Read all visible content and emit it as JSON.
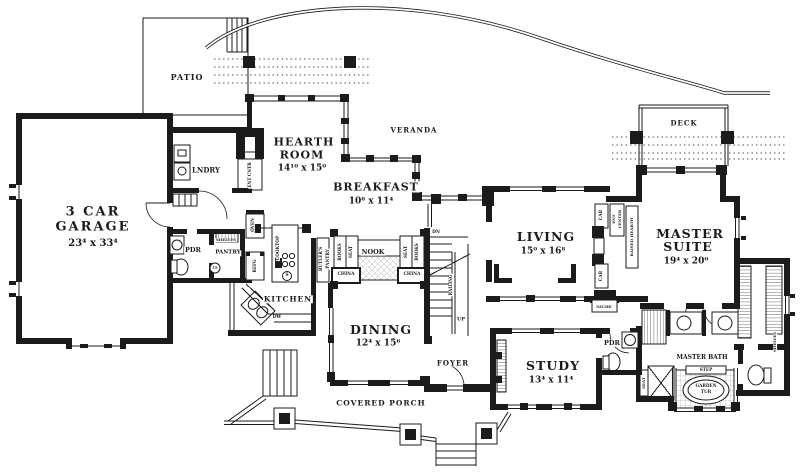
{
  "colors": {
    "ink": "#1b1b1b",
    "paper": "#ffffff",
    "dots": "#555555"
  },
  "plan_type": "single-story house floor plan",
  "rooms": [
    {
      "name": "3 Car Garage",
      "dims": "23⁴ x 33⁴"
    },
    {
      "name": "Hearth Room",
      "dims": "14¹⁰ x 15⁰"
    },
    {
      "name": "Breakfast",
      "dims": "10⁸ x 11⁴"
    },
    {
      "name": "Living",
      "dims": "15⁰ x 16⁸"
    },
    {
      "name": "Master Suite",
      "dims": "19⁴ x 20⁰"
    },
    {
      "name": "Dining",
      "dims": "12⁴ x 15⁶"
    },
    {
      "name": "Study",
      "dims": "13⁴ x 11⁴"
    },
    {
      "name": "Patio"
    },
    {
      "name": "Veranda"
    },
    {
      "name": "Deck"
    },
    {
      "name": "Kitchen"
    },
    {
      "name": "Pantry"
    },
    {
      "name": "Lndry"
    },
    {
      "name": "Foyer"
    },
    {
      "name": "Nook"
    },
    {
      "name": "Covered Porch"
    },
    {
      "name": "Master Bath"
    },
    {
      "name": "Pdr"
    }
  ],
  "labels": [
    {
      "id": "patio",
      "text": "PATIO",
      "x": 187,
      "y": 77,
      "fs": 8,
      "ls": 1
    },
    {
      "id": "garage-line1",
      "text": "3 CAR",
      "x": 93,
      "y": 212,
      "fs": 13,
      "ls": 2
    },
    {
      "id": "garage-line2",
      "text": "GARAGE",
      "x": 93,
      "y": 227,
      "fs": 13,
      "ls": 2
    },
    {
      "id": "garage-dims",
      "text": "23⁴ x 33⁴",
      "x": 93,
      "y": 244,
      "fs": 10
    },
    {
      "id": "lndry",
      "text": "LNDRY",
      "x": 206,
      "y": 170,
      "fs": 7
    },
    {
      "id": "ent-cntr",
      "text": "ENT CNTR",
      "x": 250,
      "y": 175,
      "fs": 4.2,
      "rot": -90
    },
    {
      "id": "hearth-line1",
      "text": "HEARTH",
      "x": 304,
      "y": 142,
      "fs": 11,
      "ls": 1
    },
    {
      "id": "hearth-line2",
      "text": "ROOM",
      "x": 302,
      "y": 155,
      "fs": 11,
      "ls": 1
    },
    {
      "id": "hearth-dims",
      "text": "14¹⁰ x 15⁰",
      "x": 302,
      "y": 169,
      "fs": 9
    },
    {
      "id": "veranda",
      "text": "VERANDA",
      "x": 414,
      "y": 130,
      "fs": 7,
      "ls": 1
    },
    {
      "id": "breakfast",
      "text": "BREAKFAST",
      "x": 376,
      "y": 187,
      "fs": 11,
      "ls": 1
    },
    {
      "id": "breakfast-dims",
      "text": "10⁸ x 11⁴",
      "x": 371,
      "y": 202,
      "fs": 9
    },
    {
      "id": "deck",
      "text": "DECK",
      "x": 684,
      "y": 123,
      "fs": 7,
      "ls": 1
    },
    {
      "id": "living",
      "text": "LIVING",
      "x": 546,
      "y": 237,
      "fs": 12.5,
      "ls": 1
    },
    {
      "id": "living-dims",
      "text": "15⁰ x 16⁸",
      "x": 543,
      "y": 252,
      "fs": 9
    },
    {
      "id": "master-line1",
      "text": "MASTER",
      "x": 690,
      "y": 234,
      "fs": 12.5,
      "ls": 1
    },
    {
      "id": "master-line2",
      "text": "SUITE",
      "x": 688,
      "y": 247,
      "fs": 12.5,
      "ls": 1
    },
    {
      "id": "master-dims",
      "text": "19⁴ x 20⁰",
      "x": 686,
      "y": 262,
      "fs": 9
    },
    {
      "id": "kitchen",
      "text": "KITCHEN",
      "x": 288,
      "y": 299,
      "fs": 7.5,
      "ls": 1
    },
    {
      "id": "cooktop",
      "text": "COOKTOP",
      "x": 278,
      "y": 248,
      "fs": 4.2,
      "rot": -90
    },
    {
      "id": "stove-s",
      "text": "S",
      "x": 287,
      "y": 276,
      "fs": 4.5
    },
    {
      "id": "nook",
      "text": "NOOK",
      "x": 373,
      "y": 252,
      "fs": 6.5
    },
    {
      "id": "butlers-line1",
      "text": "BUTLER'S",
      "x": 321,
      "y": 259,
      "fs": 4.2,
      "rot": -90
    },
    {
      "id": "butlers-line2",
      "text": "PANTRY",
      "x": 328,
      "y": 259,
      "fs": 4.2,
      "rot": -90
    },
    {
      "id": "books-left",
      "text": "BOOKS",
      "x": 340,
      "y": 252,
      "fs": 4.2,
      "rot": -90
    },
    {
      "id": "seat-left",
      "text": "SEAT",
      "x": 351,
      "y": 252,
      "fs": 4.2,
      "rot": -90
    },
    {
      "id": "seat-right",
      "text": "SEAT",
      "x": 406,
      "y": 252,
      "fs": 4.2,
      "rot": -90
    },
    {
      "id": "books-right",
      "text": "BOOKS",
      "x": 417,
      "y": 252,
      "fs": 4.2,
      "rot": -90
    },
    {
      "id": "china-left",
      "text": "CHINA",
      "x": 346,
      "y": 275,
      "fs": 4.4
    },
    {
      "id": "china-right",
      "text": "CHINA",
      "x": 412,
      "y": 275,
      "fs": 4.4
    },
    {
      "id": "dn",
      "text": "DN",
      "x": 436,
      "y": 233,
      "fs": 4.4
    },
    {
      "id": "railing",
      "text": "RAILING",
      "x": 451,
      "y": 285,
      "fs": 4.2,
      "rot": -90
    },
    {
      "id": "up",
      "text": "UP",
      "x": 461,
      "y": 320,
      "fs": 5
    },
    {
      "id": "dining",
      "text": "DINING",
      "x": 381,
      "y": 330,
      "fs": 12.5,
      "ls": 1
    },
    {
      "id": "dining-dims",
      "text": "12⁴ x 15⁶",
      "x": 378,
      "y": 344,
      "fs": 9
    },
    {
      "id": "foyer",
      "text": "FOYER",
      "x": 453,
      "y": 363,
      "fs": 7,
      "ls": 1
    },
    {
      "id": "study",
      "text": "STUDY",
      "x": 553,
      "y": 366,
      "fs": 12.5,
      "ls": 1
    },
    {
      "id": "study-dims",
      "text": "13⁴ x 11⁴",
      "x": 551,
      "y": 381,
      "fs": 9
    },
    {
      "id": "pdr-right",
      "text": "PDR",
      "x": 612,
      "y": 343,
      "fs": 6.5
    },
    {
      "id": "pdr-left",
      "text": "PDR",
      "x": 193,
      "y": 250,
      "fs": 6.5
    },
    {
      "id": "pantry",
      "text": "PANTRY",
      "x": 228,
      "y": 253,
      "fs": 5.5
    },
    {
      "id": "shelves-pantry",
      "text": "SHELVES",
      "x": 226,
      "y": 240,
      "fs": 3.8
    },
    {
      "id": "lazy-susan",
      "text": "LS",
      "x": 215,
      "y": 268,
      "fs": 3.5
    },
    {
      "id": "refg",
      "text": "REFG",
      "x": 255,
      "y": 266,
      "fs": 4.2,
      "rot": -90
    },
    {
      "id": "oven",
      "text": "OVEN",
      "x": 253,
      "y": 225,
      "fs": 4.2,
      "rot": -90
    },
    {
      "id": "dw",
      "text": "DW",
      "x": 277,
      "y": 318,
      "fs": 4.4
    },
    {
      "id": "master-bath",
      "text": "MASTER BATH",
      "x": 702,
      "y": 358,
      "fs": 6
    },
    {
      "id": "step",
      "text": "STEP",
      "x": 706,
      "y": 370,
      "fs": 4.2
    },
    {
      "id": "garden-tub-line1",
      "text": "GARDEN",
      "x": 706,
      "y": 386,
      "fs": 4.2
    },
    {
      "id": "garden-tub-line2",
      "text": "TUB",
      "x": 706,
      "y": 392,
      "fs": 4.2
    },
    {
      "id": "seat-shower",
      "text": "SEAT",
      "x": 644,
      "y": 383,
      "fs": 4,
      "rot": -90
    },
    {
      "id": "shelves-closet",
      "text": "SHELVES",
      "x": 775,
      "y": 342,
      "fs": 3.8,
      "rot": -90
    },
    {
      "id": "covered-porch",
      "text": "COVERED PORCH",
      "x": 381,
      "y": 403,
      "fs": 7.5,
      "ls": 1
    },
    {
      "id": "niche",
      "text": "NICHE",
      "x": 604,
      "y": 307,
      "fs": 4
    },
    {
      "id": "cab-upper",
      "text": "CAB",
      "x": 601,
      "y": 215,
      "fs": 4.2,
      "rot": -90
    },
    {
      "id": "cab-lower",
      "text": "CAB",
      "x": 601,
      "y": 276,
      "fs": 4.2,
      "rot": -90
    },
    {
      "id": "ent-center-line1",
      "text": "ENT",
      "x": 614,
      "y": 219,
      "fs": 3.8,
      "rot": -90
    },
    {
      "id": "ent-center-line2",
      "text": "CENTER",
      "x": 620,
      "y": 219,
      "fs": 3.8,
      "rot": -90
    },
    {
      "id": "raised-hearth",
      "text": "RAISED HEARTH",
      "x": 632,
      "y": 237,
      "fs": 4,
      "rot": -90
    }
  ]
}
